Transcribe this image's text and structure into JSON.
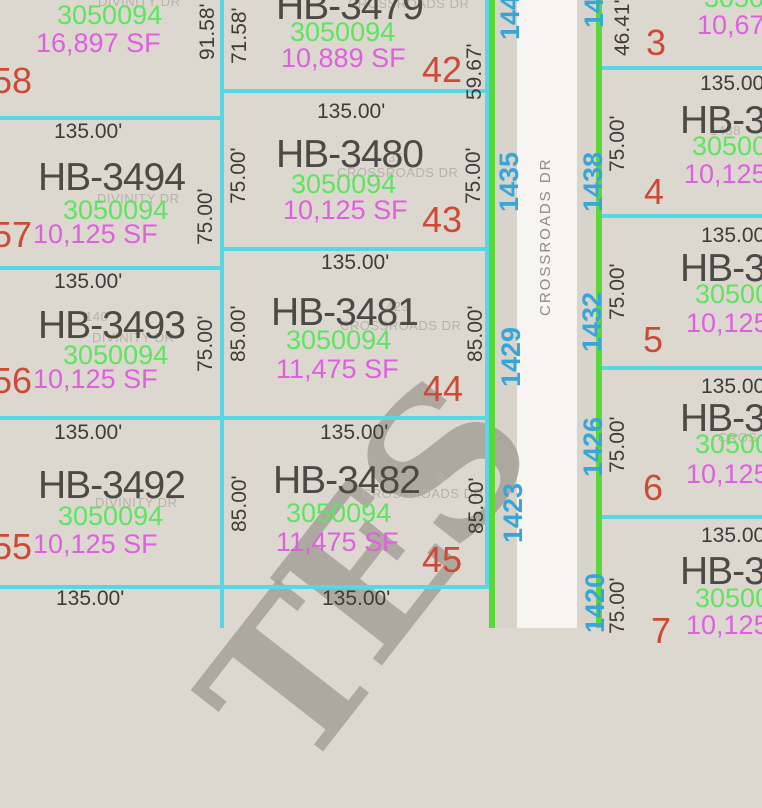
{
  "map_title": "Crossroads Dr plat map",
  "street": {
    "name": "CROSSROADS DR",
    "cross_street": "DIVINITY DR",
    "addresses_left": [
      "144",
      "1435",
      "1429",
      "1423"
    ],
    "addresses_right": [
      "144",
      "1438",
      "1432",
      "1426",
      "1420"
    ]
  },
  "watermark": {
    "letters": [
      "S",
      "E",
      "T"
    ]
  },
  "colors": {
    "parcel_fill": "#dcd8d0",
    "road_fill": "#f6f5f2",
    "road_shoulder": "#d8d4cc",
    "boundary_line": "#57d7e4",
    "road_edge_line": "#5ad83a",
    "parcel_id_text": "#4b4a45",
    "apn_text": "#5ee45f",
    "area_text": "#de60de",
    "lot_number_text": "#cd4a36",
    "address_text": "#37a5d8",
    "dimension_text": "#3d3c38"
  },
  "parcels": {
    "top_left": {
      "apn": "3050094",
      "area": "16,897 SF",
      "lot": "58",
      "dim_right": "91.58'"
    },
    "hb3494": {
      "id": "HB-3494",
      "apn": "3050094",
      "area": "10,125 SF",
      "lot": "57",
      "dim_top": "135.00'",
      "dim_right": "75.00'"
    },
    "hb3493": {
      "id": "HB-3493",
      "apn": "3050094",
      "area": "10,125 SF",
      "lot": "56",
      "dim_top": "135.00'",
      "dim_right": "75.00'",
      "ghost_num": "140"
    },
    "hb3492": {
      "id": "HB-3492",
      "apn": "3050094",
      "area": "10,125 SF",
      "lot": "55",
      "dim_top": "135.00'"
    },
    "bottom_left": {
      "dim_top": "135.00'"
    },
    "hb3479": {
      "id": "HB-3479",
      "apn": "3050094",
      "area": "10,889 SF",
      "lot": "42",
      "dim_left": "71.58'",
      "dim_right": "59.67'"
    },
    "hb3480": {
      "id": "HB-3480",
      "apn": "3050094",
      "area": "10,125 SF",
      "lot": "43",
      "dim_top": "135.00'",
      "dim_left": "75.00'",
      "dim_right": "75.00'",
      "ghost_num": "35"
    },
    "hb3481": {
      "id": "HB-3481",
      "apn": "3050094",
      "area": "11,475 SF",
      "lot": "44",
      "dim_top": "135.00'",
      "dim_left": "85.00'",
      "dim_right": "85.00'",
      "ghost_num": "429"
    },
    "hb3482": {
      "id": "HB-3482",
      "apn": "3050094",
      "area": "11,475 SF",
      "lot": "45",
      "dim_top": "135.00'",
      "dim_left": "85.00'",
      "dim_right": "85.00'",
      "ghost_num": "3"
    },
    "bottom_mid": {
      "dim_top": "135.00'"
    },
    "lot3": {
      "apn": "3050",
      "area": "10,67",
      "lot": "3",
      "dim_left": "46.41'"
    },
    "lot4": {
      "id": "HB-34",
      "apn": "30500",
      "area": "10,125",
      "lot": "4",
      "dim_top": "135.00",
      "dim_left": "75.00'",
      "ghost_num": "1438"
    },
    "lot5": {
      "id": "HB-34",
      "apn": "30500",
      "area": "10,125",
      "lot": "5",
      "dim_top": "135.00",
      "dim_left": "75.00'"
    },
    "lot6": {
      "id": "HB-34",
      "apn": "30500",
      "area": "10,125",
      "lot": "6",
      "dim_top": "135.00",
      "dim_left": "75.00'",
      "ghost_text": "CROS"
    },
    "lot7": {
      "id": "HB-34",
      "apn": "30500",
      "area": "10,125",
      "lot": "7",
      "dim_top": "135.00",
      "dim_left": "75.00'"
    }
  }
}
